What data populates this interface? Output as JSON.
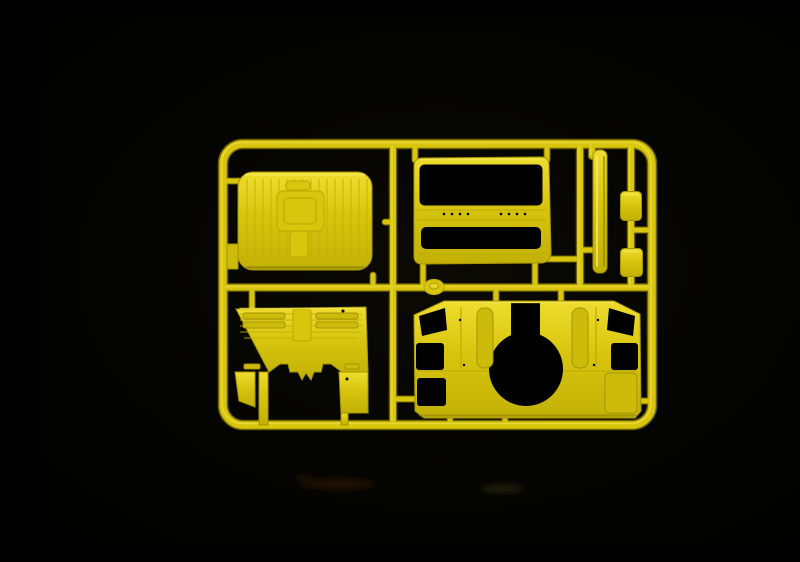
{
  "scene": {
    "description": "Photograph of a bright yellow injection-molded styrene sprue (model-kit parts tree) with truck cab parts, lit against a black studio background"
  },
  "colors": {
    "background": "#020202",
    "plastic-base": "#d8c50e",
    "plastic-light": "#eedd2e",
    "plastic-highlight": "#f6e85c",
    "plastic-shadow": "#a59404",
    "groove": "#bfae06",
    "recess": "#cdbb0a",
    "hole": "#000000"
  },
  "sprue": {
    "frame": "rounded rectangular runner frame",
    "parts": [
      {
        "id": "cab-roof-panel",
        "desc": "ribbed cab roof panel with rectangular sunroof hatch"
      },
      {
        "id": "cab-front-panel",
        "desc": "cab front panel with windscreen and grille openings"
      },
      {
        "id": "side-trim-strip",
        "desc": "narrow vertical trim strip"
      },
      {
        "id": "mirror-housing-upper",
        "desc": "small rounded rectangular housing"
      },
      {
        "id": "mirror-housing-lower",
        "desc": "small rounded rectangular housing"
      },
      {
        "id": "cab-rear-wall",
        "desc": "ribbed cab rear wall panel with notched lower edge"
      },
      {
        "id": "cab-floor-tunnel",
        "desc": "cab floor panel with large circular engine-tunnel opening"
      }
    ],
    "gate": {
      "id": "injection-gate",
      "desc": "round injection gate boss on centre runner"
    }
  }
}
